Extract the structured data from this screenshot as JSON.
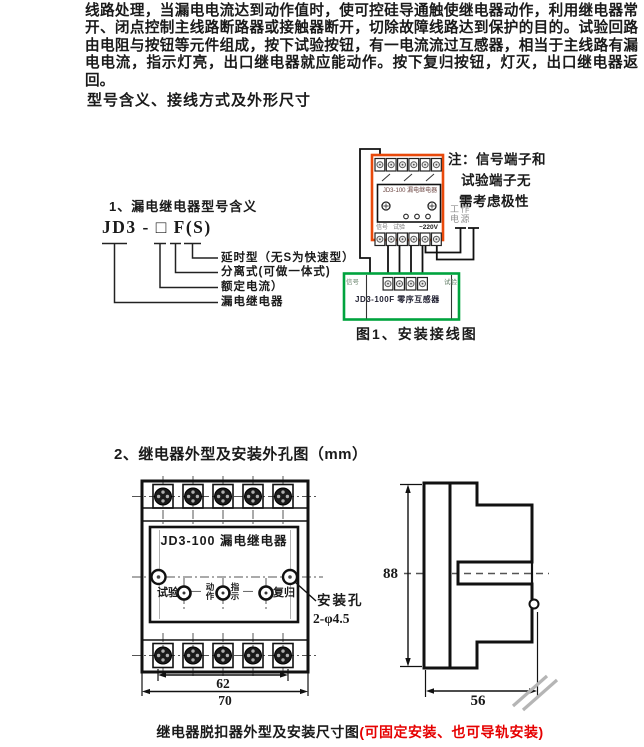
{
  "intro": {
    "text": "线路处理，当漏电电流达到动作值时，使可控硅导通触使继电器动作，利用继电器常开、闭点控制主线路断路器或接触器断开，切除故障线路达到保护的目的。试验回路由电阻与按钮等元件组成，按下试验按钮，有一电流流过互感器，相当于主线路有漏电电流，指示灯亮，出口继电器就应能动作。按下复归按钮，灯灭，出口继电器返回。"
  },
  "sections": {
    "s1_title": "型号含义、接线方式及外形尺寸",
    "s2_title": "2、继电器外型及安装外孔图（mm）"
  },
  "model_legend": {
    "subtitle": "1、漏电继电器型号含义",
    "code": "JD3 - □ F(S)",
    "labels": [
      "延时型（无S为快速型）",
      "分离式(可做一体式)",
      "额定电流）",
      "漏电继电器"
    ]
  },
  "wiring": {
    "note": {
      "line1": "注：信号端子和",
      "line2": "试验端子无",
      "line3": "需考虑极性"
    },
    "power": {
      "line1": "工作",
      "line2": "电源"
    },
    "relay": {
      "title": "JD3-100 漏电继电器",
      "signal": "信号",
      "test": "试验",
      "voltage": "~220V"
    },
    "transformer": {
      "signal": "信号",
      "test": "试验",
      "title": "JD3-100F 零序互感器"
    },
    "caption": "图1、安装接线图"
  },
  "outline": {
    "front": {
      "title": "JD3-100 漏电继电器",
      "test": "试验",
      "action": "动作",
      "indicate": "指示",
      "reset": "复归",
      "dash": "—",
      "dim_62": "62",
      "dim_70": "70",
      "hole_label": "安装孔",
      "hole_spec": "2-φ4.5"
    },
    "side": {
      "dim_88": "88",
      "dim_56": "56"
    },
    "caption_black": "继电器脱扣器外型及安装尺寸图",
    "caption_red": "(可固定安装、也可导轨安装)"
  },
  "colors": {
    "relay_outline": "#e8490b",
    "transformer_outline": "#00a33e",
    "caption_red": "#e60000"
  }
}
